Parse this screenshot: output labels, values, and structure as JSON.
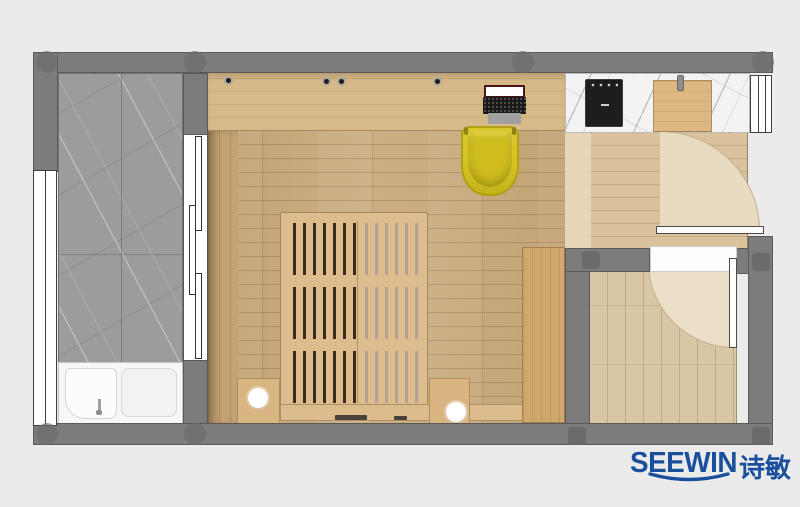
{
  "branding": {
    "logo_text": "SEEWIN",
    "logo_cjk": "诗敏",
    "logo_color": "#1a4f9d"
  },
  "palette": {
    "background": "#ebebeb",
    "wall_gray": "#7c7c7c",
    "bathroom_marble": "#9d9b9d",
    "counter_marble": "#f3f3f3",
    "bedroom_floor_wood": "#c8aa7c",
    "desk_wood": "#d8b988",
    "bed_wood": "#ddbd8d",
    "bench_wood": "#d0a76c",
    "hallway_floor_wood": "#d9c29c",
    "back_room_floor_wood": "#d9c6a5",
    "chair_yellow": "#d8c62a",
    "cooktop_black": "#1d1d1d",
    "bathtub_white": "#f7f7f7",
    "door_swing_beige": "#e8dbc1"
  },
  "elements": {
    "rooms": [
      "bathroom",
      "bedroom",
      "kitchen-hallway",
      "back-room"
    ],
    "furniture": [
      "bathtub",
      "sliding-glass-door",
      "desk",
      "laptop",
      "tub-chair",
      "slatted-platform-bed",
      "nightstand-left",
      "nightstand-right",
      "lamp-left",
      "lamp-right",
      "storage-bench",
      "cooktop",
      "cutting-board",
      "hallway-door-swing",
      "back-room-door-swing",
      "window-left",
      "window-right"
    ]
  }
}
